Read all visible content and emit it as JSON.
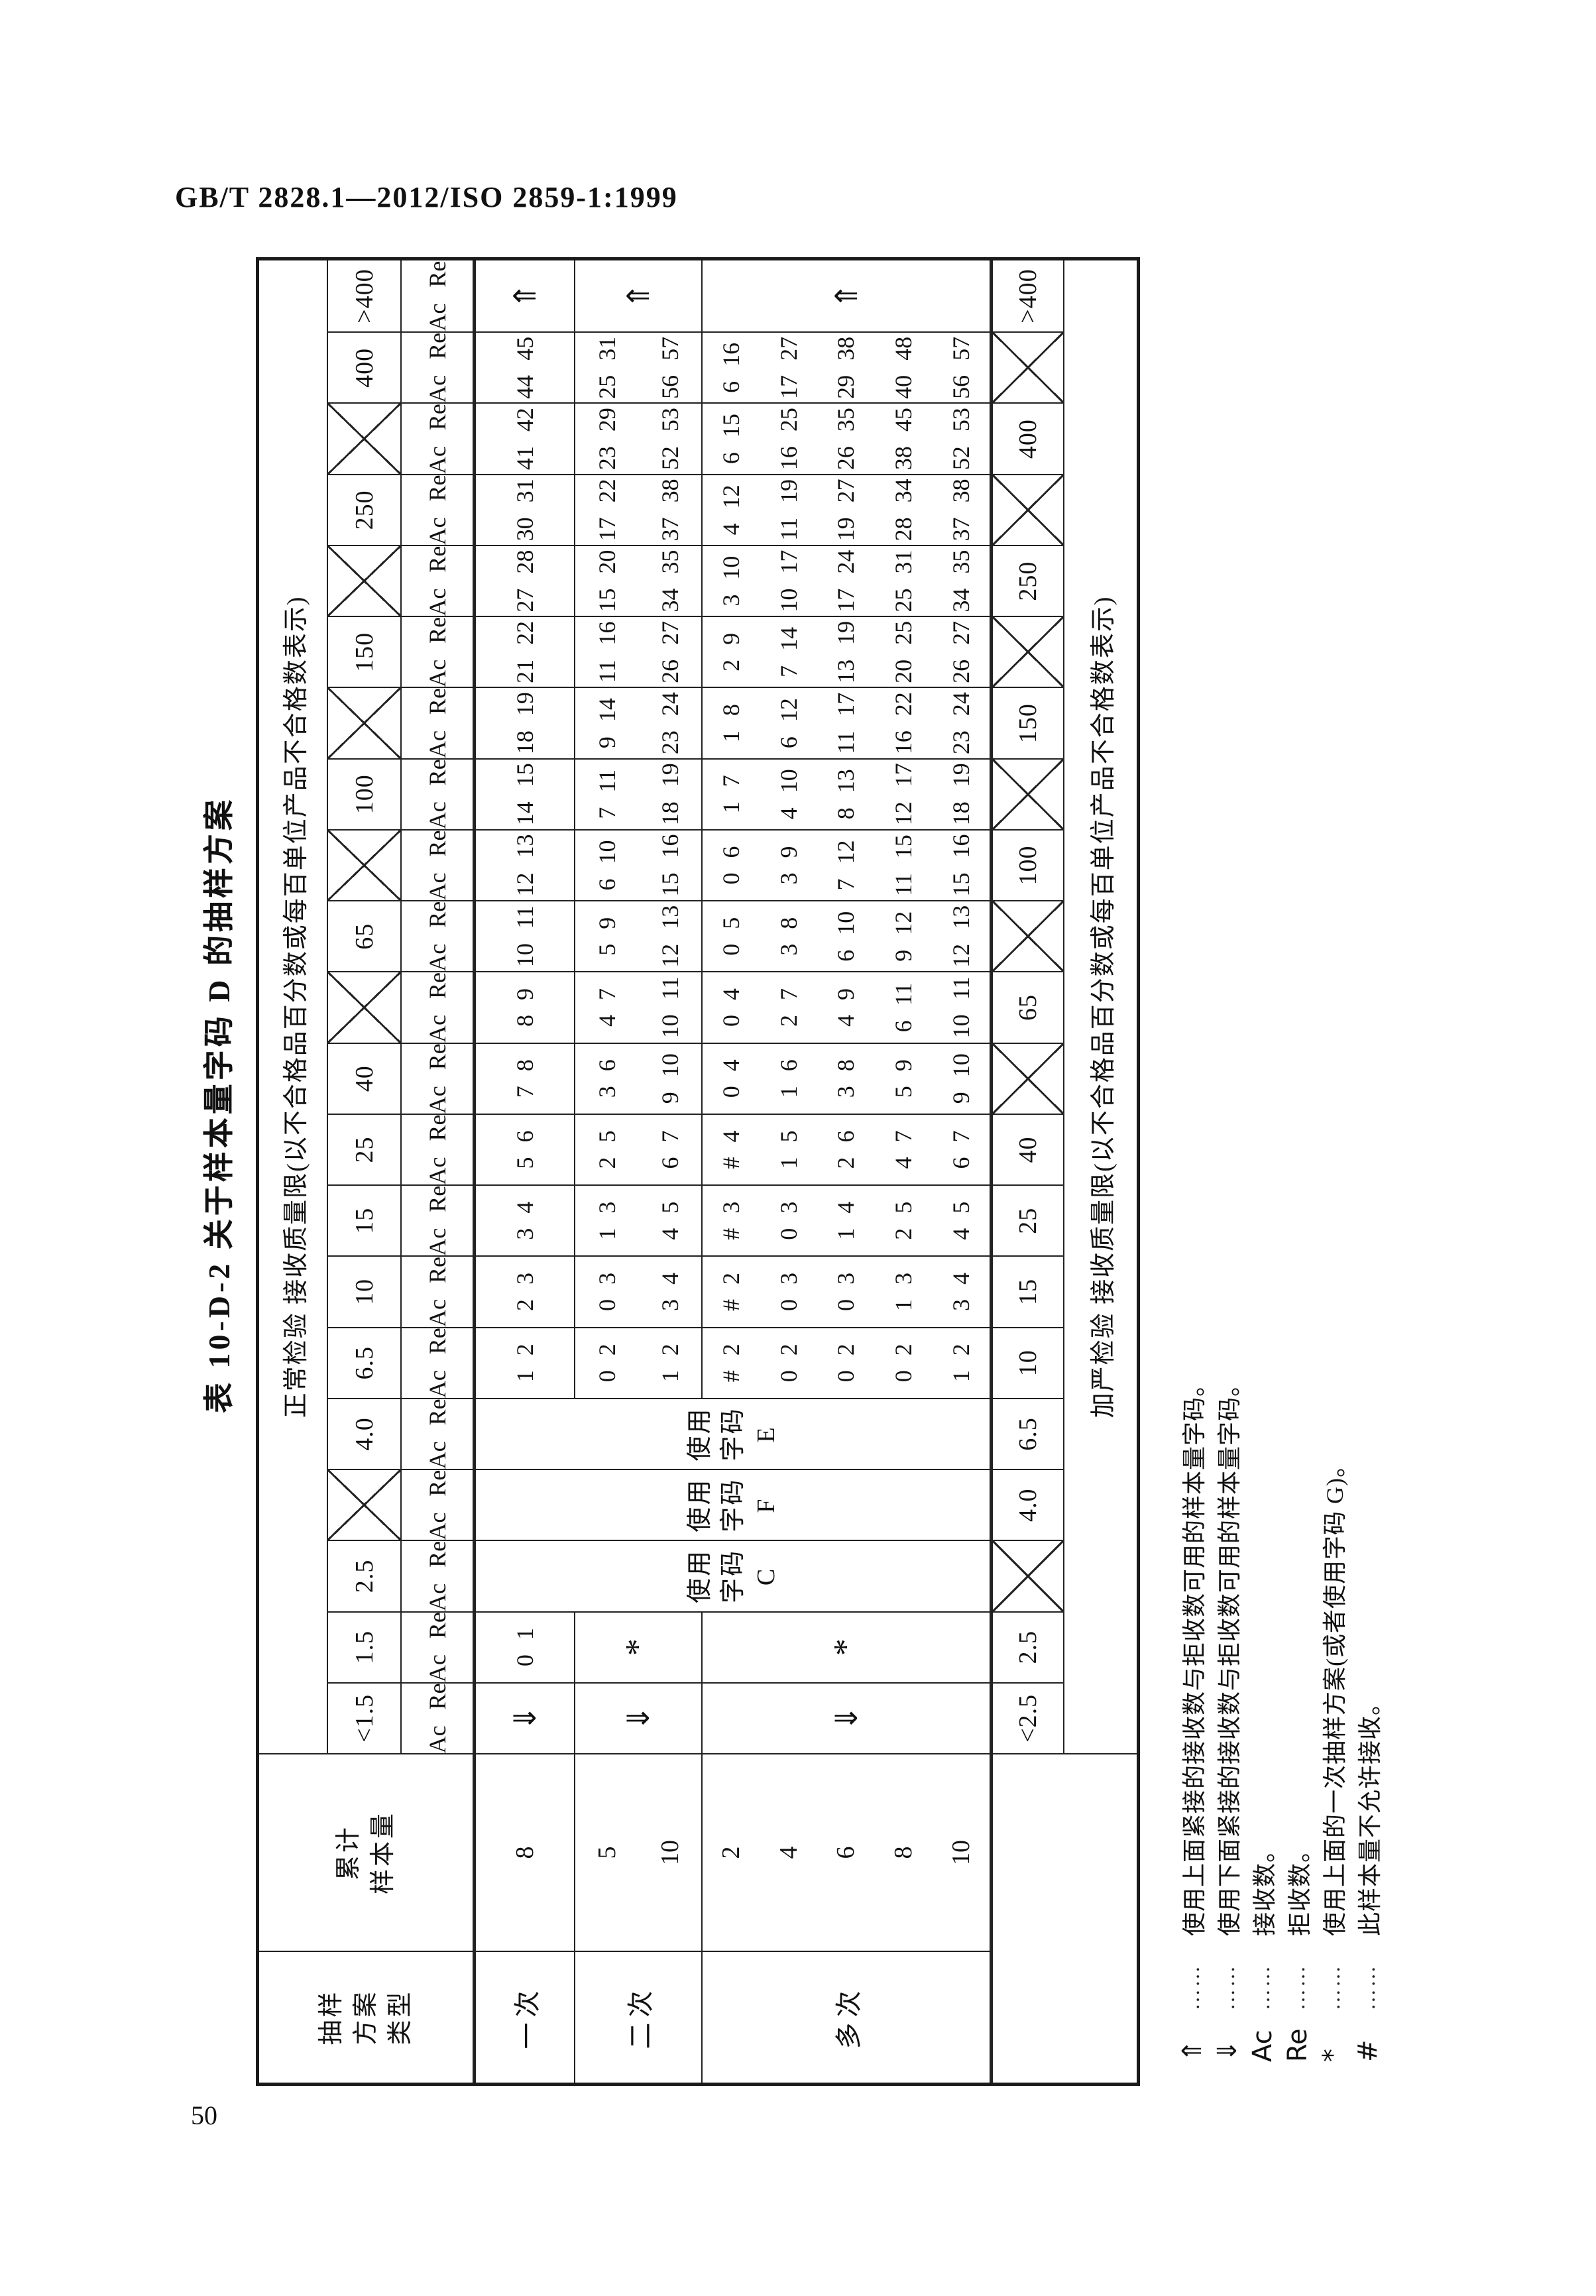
{
  "page": {
    "header": "GB/T 2828.1—2012/ISO 2859-1:1999",
    "page_number": "50"
  },
  "table": {
    "title": "表 10-D-2  关于样本量字码 D 的抽样方案",
    "normal_header": "正常检验   接收质量限(以不合格品百分数或每百单位产品不合格数表示)",
    "tightened_header": "加严检验   接收质量限(以不合格品百分数或每百单位产品不合格数表示)",
    "plan_type_header_lines": [
      "抽样",
      "方案",
      "类型"
    ],
    "cum_sample_header_lines": [
      "累计",
      "样本量"
    ],
    "ac_label": "Ac",
    "re_label": "Re",
    "up_arrow": "⇑",
    "down_arrow": "⇓",
    "asterisk": "*",
    "hash": "#",
    "plan_rows": [
      {
        "type": "一次",
        "sizes": [
          "8"
        ]
      },
      {
        "type": "二次",
        "sizes": [
          "5",
          "10"
        ]
      },
      {
        "type": "多次",
        "sizes": [
          "2",
          "4",
          "6",
          "8",
          "10"
        ]
      }
    ],
    "columns": [
      {
        "normal": "<1.5",
        "tightened": "<2.5",
        "single": "⇓",
        "double": "⇓",
        "multiple": "⇓"
      },
      {
        "normal": "1.5",
        "tightened": "2.5",
        "single": [
          "0",
          "1"
        ],
        "double": "*",
        "multiple": "*"
      },
      {
        "normal": "2.5",
        "tightened": null,
        "note": [
          "使用",
          "字码",
          "C"
        ]
      },
      {
        "normal": null,
        "tightened": "4.0",
        "note": [
          "使用",
          "字码",
          "F"
        ]
      },
      {
        "normal": "4.0",
        "tightened": "6.5",
        "note": [
          "使用",
          "字码",
          "E"
        ]
      },
      {
        "normal": "6.5",
        "tightened": "10",
        "single": [
          "1",
          "2"
        ],
        "double": [
          [
            "0",
            "2"
          ],
          [
            "1",
            "2"
          ]
        ],
        "multiple": [
          [
            "#",
            "2"
          ],
          [
            "0",
            "2"
          ],
          [
            "0",
            "2"
          ],
          [
            "0",
            "2"
          ],
          [
            "1",
            "2"
          ]
        ]
      },
      {
        "normal": "10",
        "tightened": "15",
        "single": [
          "2",
          "3"
        ],
        "double": [
          [
            "0",
            "3"
          ],
          [
            "3",
            "4"
          ]
        ],
        "multiple": [
          [
            "#",
            "2"
          ],
          [
            "0",
            "3"
          ],
          [
            "0",
            "3"
          ],
          [
            "1",
            "3"
          ],
          [
            "3",
            "4"
          ]
        ]
      },
      {
        "normal": "15",
        "tightened": "25",
        "single": [
          "3",
          "4"
        ],
        "double": [
          [
            "1",
            "3"
          ],
          [
            "4",
            "5"
          ]
        ],
        "multiple": [
          [
            "#",
            "3"
          ],
          [
            "0",
            "3"
          ],
          [
            "1",
            "4"
          ],
          [
            "2",
            "5"
          ],
          [
            "4",
            "5"
          ]
        ]
      },
      {
        "normal": "25",
        "tightened": "40",
        "single": [
          "5",
          "6"
        ],
        "double": [
          [
            "2",
            "5"
          ],
          [
            "6",
            "7"
          ]
        ],
        "multiple": [
          [
            "#",
            "4"
          ],
          [
            "1",
            "5"
          ],
          [
            "2",
            "6"
          ],
          [
            "4",
            "7"
          ],
          [
            "6",
            "7"
          ]
        ]
      },
      {
        "normal": "40",
        "tightened": null,
        "single": [
          "7",
          "8"
        ],
        "double": [
          [
            "3",
            "6"
          ],
          [
            "9",
            "10"
          ]
        ],
        "multiple": [
          [
            "0",
            "4"
          ],
          [
            "1",
            "6"
          ],
          [
            "3",
            "8"
          ],
          [
            "5",
            "9"
          ],
          [
            "9",
            "10"
          ]
        ]
      },
      {
        "normal": null,
        "tightened": "65",
        "single": [
          "8",
          "9"
        ],
        "double": [
          [
            "4",
            "7"
          ],
          [
            "10",
            "11"
          ]
        ],
        "multiple": [
          [
            "0",
            "4"
          ],
          [
            "2",
            "7"
          ],
          [
            "4",
            "9"
          ],
          [
            "6",
            "11"
          ],
          [
            "10",
            "11"
          ]
        ]
      },
      {
        "normal": "65",
        "tightened": null,
        "single": [
          "10",
          "11"
        ],
        "double": [
          [
            "5",
            "9"
          ],
          [
            "12",
            "13"
          ]
        ],
        "multiple": [
          [
            "0",
            "5"
          ],
          [
            "3",
            "8"
          ],
          [
            "6",
            "10"
          ],
          [
            "9",
            "12"
          ],
          [
            "12",
            "13"
          ]
        ]
      },
      {
        "normal": null,
        "tightened": "100",
        "single": [
          "12",
          "13"
        ],
        "double": [
          [
            "6",
            "10"
          ],
          [
            "15",
            "16"
          ]
        ],
        "multiple": [
          [
            "0",
            "6"
          ],
          [
            "3",
            "9"
          ],
          [
            "7",
            "12"
          ],
          [
            "11",
            "15"
          ],
          [
            "15",
            "16"
          ]
        ]
      },
      {
        "normal": "100",
        "tightened": null,
        "single": [
          "14",
          "15"
        ],
        "double": [
          [
            "7",
            "11"
          ],
          [
            "18",
            "19"
          ]
        ],
        "multiple": [
          [
            "1",
            "7"
          ],
          [
            "4",
            "10"
          ],
          [
            "8",
            "13"
          ],
          [
            "12",
            "17"
          ],
          [
            "18",
            "19"
          ]
        ]
      },
      {
        "normal": null,
        "tightened": "150",
        "single": [
          "18",
          "19"
        ],
        "double": [
          [
            "9",
            "14"
          ],
          [
            "23",
            "24"
          ]
        ],
        "multiple": [
          [
            "1",
            "8"
          ],
          [
            "6",
            "12"
          ],
          [
            "11",
            "17"
          ],
          [
            "16",
            "22"
          ],
          [
            "23",
            "24"
          ]
        ]
      },
      {
        "normal": "150",
        "tightened": null,
        "single": [
          "21",
          "22"
        ],
        "double": [
          [
            "11",
            "16"
          ],
          [
            "26",
            "27"
          ]
        ],
        "multiple": [
          [
            "2",
            "9"
          ],
          [
            "7",
            "14"
          ],
          [
            "13",
            "19"
          ],
          [
            "20",
            "25"
          ],
          [
            "26",
            "27"
          ]
        ]
      },
      {
        "normal": null,
        "tightened": "250",
        "single": [
          "27",
          "28"
        ],
        "double": [
          [
            "15",
            "20"
          ],
          [
            "34",
            "35"
          ]
        ],
        "multiple": [
          [
            "3",
            "10"
          ],
          [
            "10",
            "17"
          ],
          [
            "17",
            "24"
          ],
          [
            "25",
            "31"
          ],
          [
            "34",
            "35"
          ]
        ]
      },
      {
        "normal": "250",
        "tightened": null,
        "single": [
          "30",
          "31"
        ],
        "double": [
          [
            "17",
            "22"
          ],
          [
            "37",
            "38"
          ]
        ],
        "multiple": [
          [
            "4",
            "12"
          ],
          [
            "11",
            "19"
          ],
          [
            "19",
            "27"
          ],
          [
            "28",
            "34"
          ],
          [
            "37",
            "38"
          ]
        ]
      },
      {
        "normal": null,
        "tightened": "400",
        "single": [
          "41",
          "42"
        ],
        "double": [
          [
            "23",
            "29"
          ],
          [
            "52",
            "53"
          ]
        ],
        "multiple": [
          [
            "6",
            "15"
          ],
          [
            "16",
            "25"
          ],
          [
            "26",
            "35"
          ],
          [
            "38",
            "45"
          ],
          [
            "52",
            "53"
          ]
        ]
      },
      {
        "normal": "400",
        "tightened": null,
        "single": [
          "44",
          "45"
        ],
        "double": [
          [
            "25",
            "31"
          ],
          [
            "56",
            "57"
          ]
        ],
        "multiple": [
          [
            "6",
            "16"
          ],
          [
            "17",
            "27"
          ],
          [
            "29",
            "38"
          ],
          [
            "40",
            "48"
          ],
          [
            "56",
            "57"
          ]
        ]
      },
      {
        "normal": ">400",
        "tightened": ">400",
        "single": "⇑",
        "double": "⇑",
        "multiple": "⇑"
      }
    ]
  },
  "footnotes": {
    "leader": "……",
    "items": [
      {
        "symbol": "⇑",
        "text": "使用上面紧接的接收数与拒收数可用的样本量字码。"
      },
      {
        "symbol": "⇓",
        "text": "使用下面紧接的接收数与拒收数可用的样本量字码。"
      },
      {
        "symbol": "Ac",
        "text": "接收数。"
      },
      {
        "symbol": "Re",
        "text": "拒收数。"
      },
      {
        "symbol": "*",
        "text": "使用上面的一次抽样方案(或者使用字码 G)。"
      },
      {
        "symbol": "#",
        "text": "此样本量不允许接收。"
      }
    ]
  }
}
